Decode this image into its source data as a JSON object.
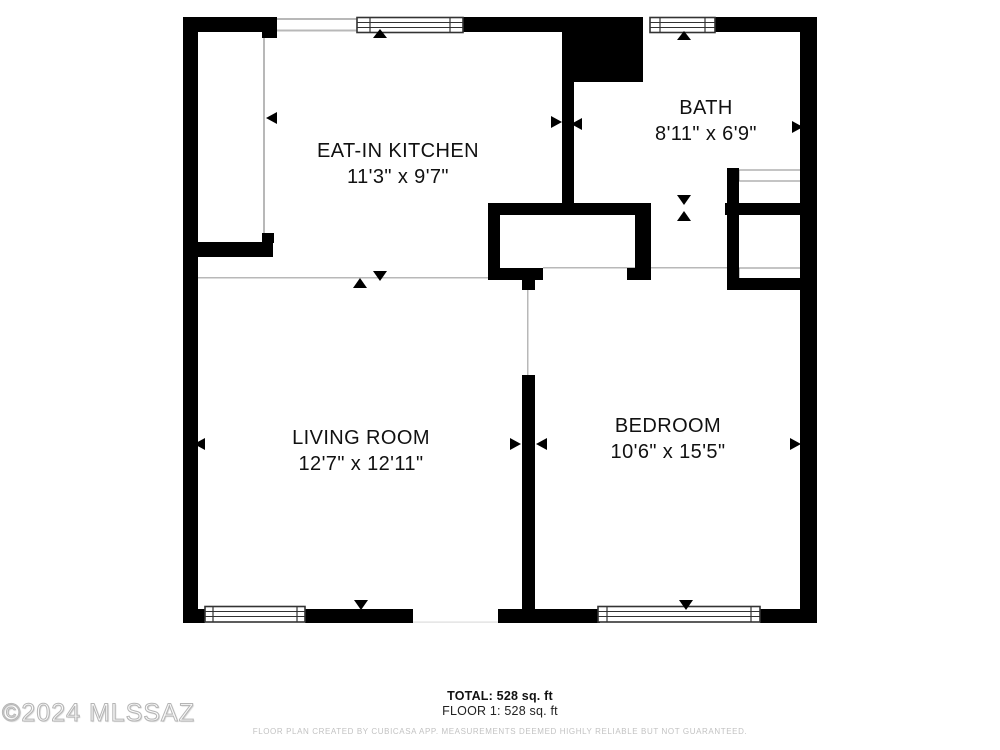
{
  "plan": {
    "rooms": [
      {
        "id": "eat-in-kitchen",
        "name": "EAT-IN KITCHEN",
        "dims": "11'3\" x 9'7\""
      },
      {
        "id": "bath",
        "name": "BATH",
        "dims": "8'11\" x 6'9\""
      },
      {
        "id": "living-room",
        "name": "LIVING ROOM",
        "dims": "12'7\" x 12'11\""
      },
      {
        "id": "bedroom",
        "name": "BEDROOM",
        "dims": "10'6\" x 15'5\""
      }
    ],
    "features": [
      "exterior-walls",
      "interior-walls",
      "windows",
      "door-openings",
      "closet-shelves",
      "utility-shaft",
      "dimension-arrows"
    ]
  },
  "footer": {
    "total": "TOTAL: 528 sq. ft",
    "floor": "FLOOR 1: 528 sq. ft",
    "disclaimer": "FLOOR PLAN CREATED BY CUBICASA APP. MEASUREMENTS DEEMED HIGHLY RELIABLE BUT NOT GUARANTEED."
  },
  "watermark": "©2024 MLSSAZ",
  "colors": {
    "wall": "#000000",
    "background": "#ffffff",
    "window_frame": "#333333",
    "thin_line": "#b8b8b8",
    "disclaimer_text": "#c2c2c2"
  }
}
